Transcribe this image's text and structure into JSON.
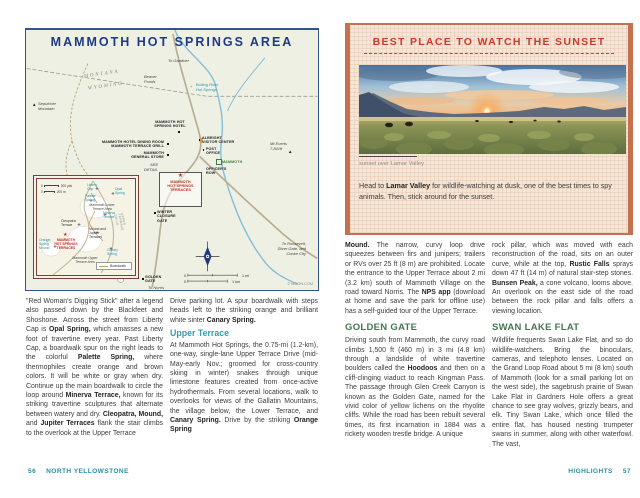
{
  "left": {
    "map": {
      "title": "MAMMOTH HOT SPRINGS AREA",
      "credit": "© MOON.COM",
      "scale": {
        "zero": "0",
        "mi": "1 mi",
        "km": "1 km"
      },
      "labels": {
        "to_gardiner": "To Gardiner",
        "montana": "MONTANA",
        "wyoming": "WYOMING",
        "sepulcher": "Sepulcher\nMountain",
        "beaver_ponds": "Beaver\nPonds",
        "boiling_river": "Boiling River\nHot Springs",
        "mt_everts": "Mt Everts\n7,841ft",
        "hotel": "MAMMOTH HOT\nSPRINGS HOTEL",
        "dining": "MAMMOTH HOTEL DINING ROOM\nMAMMOTH TERRACE GRILL",
        "general_store": "MAMMOTH\nGENERAL STORE",
        "visitor_center": "ALBRIGHT\nVISITOR CENTER",
        "post_office": "POST\nOFFICE",
        "mammoth": "MAMMOTH",
        "officers_row": "OFFICER'S\nROW",
        "see_detail": "SEE\nDETAIL",
        "terraces": "MAMMOTH\nHOT SPRINGS\nTERRACES",
        "winter_gate": "WINTER\nCLOSURE\nGATE",
        "to_roosevelt": "To Roosevelt,\nSilver Gate, and\nCooke City",
        "golden_gate": "GOLDEN\nGATE",
        "to_norris": "To Norris",
        "glen_creek": "GLEN CREEK"
      },
      "inset": {
        "scale": {
          "zero": "0",
          "yds": "200 yds",
          "m": "200 m"
        },
        "legend": "Boardwalk",
        "labels": {
          "liberty_cap": "Liberty\nCap",
          "opal_spring": "Opal\nSpring",
          "palette_spring": "Palette\nSpring",
          "lower_area": "Mammoth Lower\nTerrace Area",
          "minerva": "Minerva\nTerrace",
          "cleopatra": "Cleopatra\nTerrace",
          "mound_jupiter": "Mound and\nJupiter\nTerraces",
          "terraces": "MAMMOTH\nHOT SPRINGS\nTERRACES",
          "orange_spring": "Orange\nSpring\nMound",
          "canary": "Canary\nSpring",
          "upper_area": "Mammoth Upper\nTerrace Area",
          "upper_drive": "UPPER TERRACE DRIVE"
        }
      }
    },
    "col1_p1": "\"Red Woman's Digging Stick\" after a legend also passed down by the Blackfeet and Shoshone. Across the street from Liberty Cap is **Opal Spring,** which amasses a new foot of travertine every year. Past Liberty Cap, a boardwalk spur on the right leads to the colorful **Palette Spring,** where thermophiles create orange and brown colors. It will be white or gray when dry. Continue up the main boardwalk to circle the loop around **Minerva Terrace,** known for its striking travertine sculptures that alternate between watery and dry. **Cleopatra, Mound,** and **Jupiter Terraces** flank the stair climbs to the overlook at the Upper Terrace",
    "col2_p1": "Drive parking lot. A spur boardwalk with steps heads left to the striking orange and brilliant white sinter **Canary Spring.**",
    "col2_h1": "Upper Terrace",
    "col2_p2": "At Mammoth Hot Springs, the 0.75-mi (1.2-km), one-way, single-lane Upper Terrace Drive (mid-May-early Nov.; groomed for cross-country skiing in winter) snakes through unique limestone features created from once-active hydrothermals. From several locations, walk to overlooks for views of the Gallatin Mountains, the village below, the Lower Terrace, and **Canary Spring.** Drive by the striking **Orange Spring**",
    "footer": {
      "num": "56",
      "label": "NORTH YELLOWSTONE"
    }
  },
  "right": {
    "feature": {
      "title": "BEST PLACE TO WATCH THE SUNSET",
      "caption": "sunset over Lamar Valley",
      "intro": "Head to **Lamar Valley** for wildlife-watching at dusk, one of the best times to spy animals. Then, stick around for the sunset."
    },
    "col1_p1": "**Mound.** The narrow, curvy loop drive squeezes between firs and junipers; trailers or RVs over 25 ft (8 m) are prohibited. Locate the entrance to the Upper Terrace about 2 mi (3.2 km) south of Mammoth Village on the road toward Norris. The **NPS app** (download at home and save the park for offline use) has a self-guided tour of the Upper Terrace.",
    "col1_h1": "GOLDEN GATE",
    "col1_p2": "Driving south from Mammoth, the curvy road climbs 1,500 ft (460 m) in 3 mi (4.8 km) through a landslide of white travertine boulders called the **Hoodoos** and then on a cliff-clinging viaduct to reach Kingman Pass. The passage through Glen Creek Canyon is known as the Golden Gate, named for the vivid color of yellow lichens on the rhyolite cliffs. While the road has been rebuilt several times, its first incarnation in 1884 was a rickety wooden trestle bridge. A unique",
    "col2_p1": "rock pillar, which was moved with each reconstruction of the road, sits on an outer curve, while at the top, **Rustic Falls** sprays down 47 ft (14 m) of natural stair-step stones. **Bunsen Peak,** a cone volcano, looms above. An overlook on the east side of the road between the rock pillar and falls offers a viewing location.",
    "col2_h1": "SWAN LAKE FLAT",
    "col2_p2": "Wildlife frequents Swan Lake Flat, and so do wildlife-watchers. Bring the binoculars, cameras, and telephoto lenses. Located on the Grand Loop Road about 5 mi (8 km) south of Mammoth (look for a small parking lot on the west side), the sagebrush prairie of Swan Lake Flat in Gardners Hole offers a great chance to see gray wolves, grizzly bears, and elk. Tiny Swan Lake, which once filled the entire flat, has housed nesting trumpeter swans in summer, along with other waterfowl. The vast,",
    "footer": {
      "label": "HIGHLIGHTS",
      "num": "57"
    }
  },
  "colors": {
    "navy_title": "#1e3a85",
    "teal_heading": "#2f9db2",
    "green_heading": "#44784f",
    "red_feature": "#cc3a2e",
    "terracotta_border": "#c3714e",
    "map_red": "#c13327",
    "map_teal": "#2d93ad",
    "footer_teal": "#2b8fa6"
  }
}
